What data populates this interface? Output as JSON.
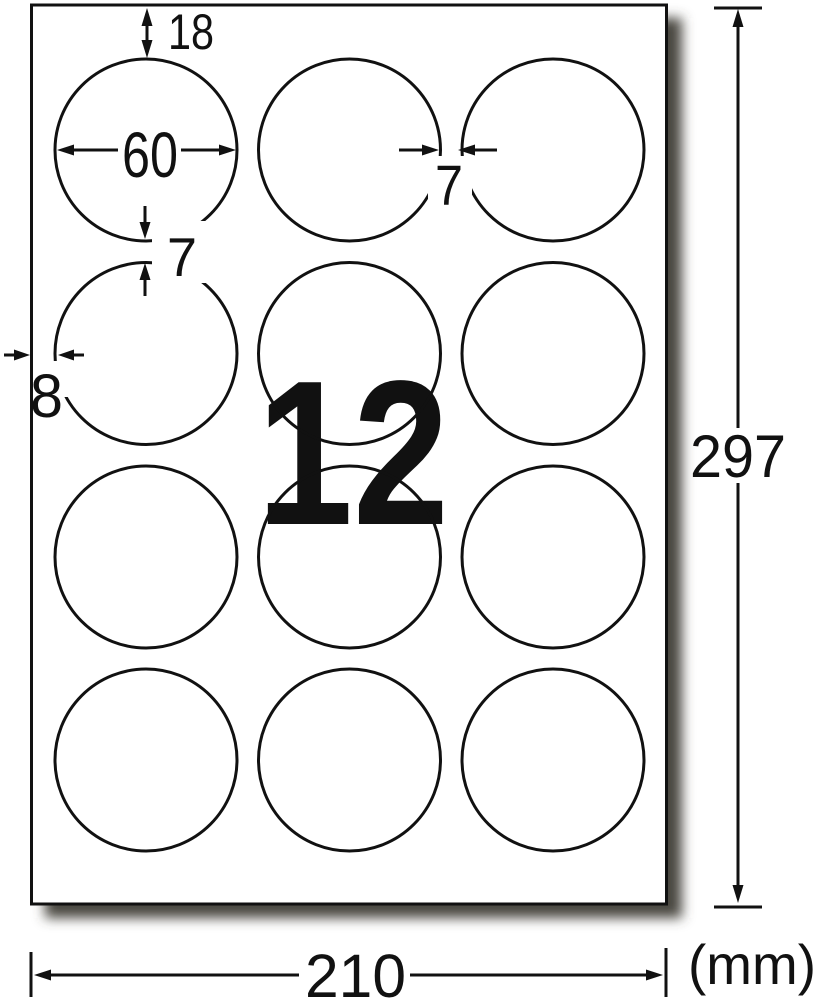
{
  "sheet": {
    "count_watermark": "12",
    "grid": {
      "rows": 4,
      "columns": 3,
      "total_labels": 12,
      "shape": "circle"
    }
  },
  "dimensions": {
    "top_margin": "18",
    "label_diameter": "60",
    "column_gap": "7",
    "row_gap": "7",
    "left_margin": "8",
    "sheet_height": "297",
    "sheet_width": "210",
    "unit": "(mm)"
  },
  "colors": {
    "watermark_pink": "#F2ABCB",
    "line_black": "#111111",
    "paper_white": "#FFFFFF",
    "shadow_gray": "#4A4741"
  }
}
